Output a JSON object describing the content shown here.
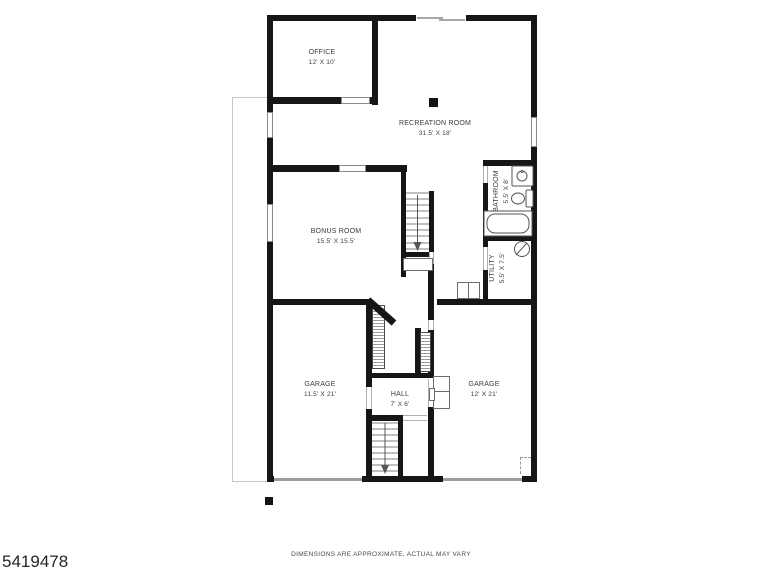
{
  "floorplan": {
    "rooms": [
      {
        "name": "OFFICE",
        "dims": "12' X 10'"
      },
      {
        "name": "RECREATION ROOM",
        "dims": "31.5' X 18'"
      },
      {
        "name": "BONUS ROOM",
        "dims": "15.5' X 15.5'"
      },
      {
        "name": "BATHROOM",
        "dims": "5.5' X 8'"
      },
      {
        "name": "UTILITY",
        "dims": "5.5' X 7.5'"
      },
      {
        "name": "GARAGE",
        "dims": "11.5' X 21'"
      },
      {
        "name": "HALL",
        "dims": "7' X 6'"
      },
      {
        "name": "GARAGE",
        "dims": "12' X 21'"
      }
    ],
    "colors": {
      "wall": "#161616",
      "fixture_line": "#555555",
      "thin_line": "#9c9c9c"
    }
  },
  "footer": {
    "disclaimer": "DIMENSIONS ARE APPROXIMATE, ACTUAL MAY VARY",
    "listing_id": "5419478"
  }
}
